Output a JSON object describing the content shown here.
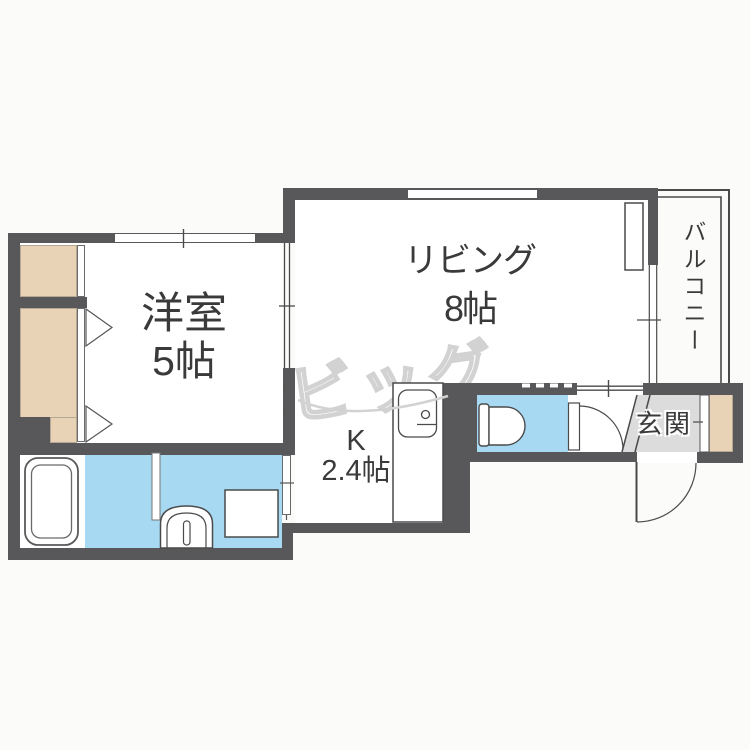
{
  "rooms": {
    "western": {
      "name": "洋室",
      "size": "5帖"
    },
    "living": {
      "name": "リビング",
      "size": "8帖"
    },
    "kitchen": {
      "name": "K",
      "size": "2.4帖"
    },
    "entrance": {
      "name": "玄関"
    },
    "balcony": {
      "name": "バルコニー"
    }
  },
  "watermark": "ビッグ",
  "colors": {
    "wall": "#58585b",
    "water": "#a7d9f2",
    "closet": "#e9d3b6",
    "entrance_floor": "#dcdcdc",
    "watermark": "#d2d2d2",
    "line": "#4a4a4a"
  }
}
